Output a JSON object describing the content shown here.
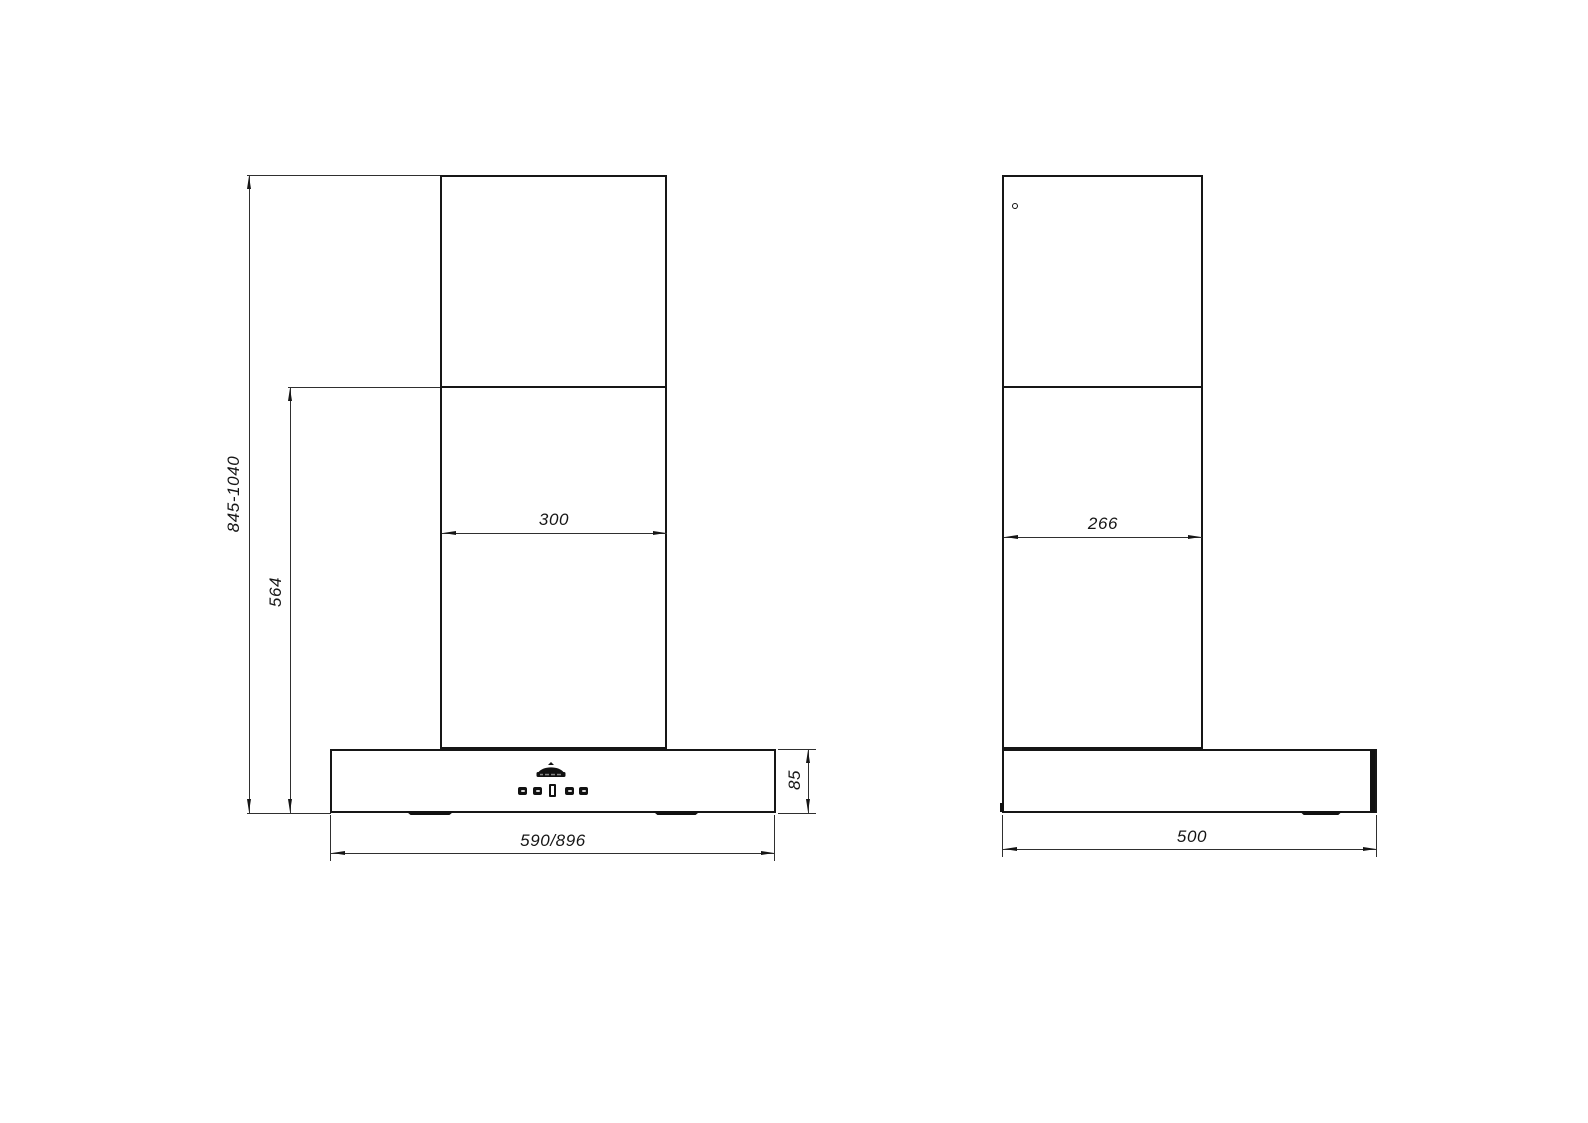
{
  "colors": {
    "line": "#161616",
    "background": "#ffffff"
  },
  "front_view": {
    "dimensions": {
      "total_height": "845-1040",
      "lower_section_height": "564",
      "chimney_width": "300",
      "canopy_height": "85",
      "canopy_width": "590/896"
    }
  },
  "side_view": {
    "dimensions": {
      "chimney_depth": "266",
      "canopy_depth": "500"
    }
  },
  "icons": {
    "logo": "brand-logo-icon",
    "controls": [
      "control-button",
      "control-button",
      "display-window",
      "control-button",
      "control-button"
    ]
  }
}
